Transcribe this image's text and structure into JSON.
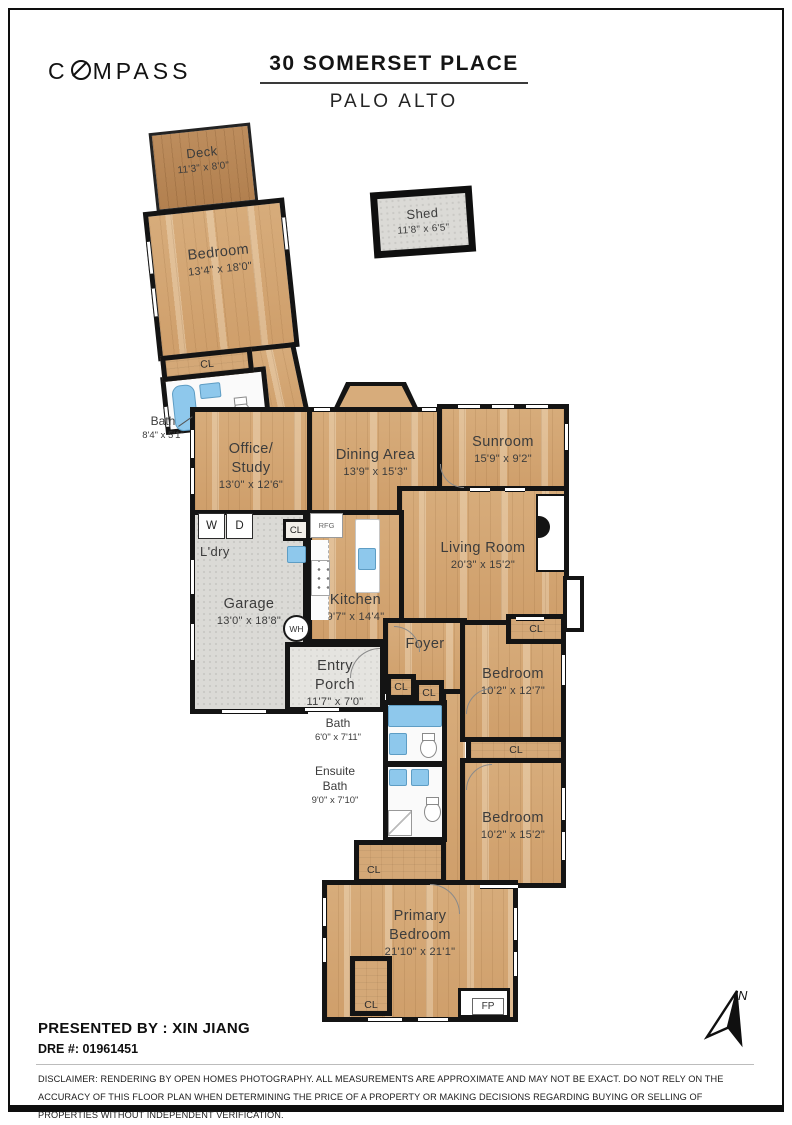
{
  "header": {
    "brand": {
      "pre": "C",
      "post": "MPASS"
    },
    "title": "30 SOMERSET PLACE",
    "subtitle": "PALO ALTO"
  },
  "rooms": {
    "deck": {
      "name": "Deck",
      "dims": "11'3\" x 8'0\""
    },
    "shed": {
      "name": "Shed",
      "dims": "11'8\" x 6'5\""
    },
    "bedroom_top": {
      "name": "Bedroom",
      "dims": "13'4\" x 18'0\""
    },
    "bath_top": {
      "name": "Bath",
      "dims": "8'4\" x 5'1\""
    },
    "office": {
      "name1": "Office/",
      "name2": "Study",
      "dims": "13'0\" x 12'6\""
    },
    "dining": {
      "name": "Dining Area",
      "dims": "13'9\" x 15'3\""
    },
    "sunroom": {
      "name": "Sunroom",
      "dims": "15'9\" x 9'2\""
    },
    "living": {
      "name": "Living Room",
      "dims": "20'3\" x 15'2\""
    },
    "kitchen": {
      "name": "Kitchen",
      "dims": "9'7\" x 14'4\""
    },
    "laundry": {
      "name": "L'dry"
    },
    "garage": {
      "name": "Garage",
      "dims": "13'0\" x 18'8\""
    },
    "entry_porch": {
      "name1": "Entry",
      "name2": "Porch",
      "dims": "11'7\" x 7'0\""
    },
    "foyer": {
      "name": "Foyer"
    },
    "hall_bath": {
      "name": "Bath",
      "dims": "6'0\" x 7'11\""
    },
    "ensuite_bath": {
      "name1": "Ensuite",
      "name2": "Bath",
      "dims": "9'0\" x 7'10\""
    },
    "bedroom_mid": {
      "name": "Bedroom",
      "dims": "10'2\" x 12'7\""
    },
    "bedroom_low": {
      "name": "Bedroom",
      "dims": "10'2\" x 15'2\""
    },
    "primary": {
      "name1": "Primary",
      "name2": "Bedroom",
      "dims": "21'10\" x 21'1\""
    }
  },
  "markers": {
    "closet": "CL",
    "washer": "W",
    "dryer": "D",
    "fridge": "RFG",
    "water_heater": "WH",
    "fireplace": "FP",
    "north": "N"
  },
  "colors": {
    "wall": "#141414",
    "wood_floor": "#d7ac7b",
    "deck_wood": "#bd8d5d",
    "concrete": "#dbdad6",
    "fixture_blue": "#8ec8ec"
  },
  "footer": {
    "presented_by": "PRESENTED BY : XIN JIANG",
    "dre": "DRE #: 01961451",
    "disclaimer": "DISCLAIMER: RENDERING BY OPEN HOMES PHOTOGRAPHY. ALL MEASUREMENTS ARE APPROXIMATE AND MAY NOT BE EXACT. DO NOT RELY ON THE ACCURACY OF THIS FLOOR PLAN WHEN DETERMINING THE PRICE OF A PROPERTY OR MAKING DECISIONS REGARDING BUYING OR SELLING OF PROPERTIES WITHOUT INDEPENDENT VERIFICATION."
  }
}
